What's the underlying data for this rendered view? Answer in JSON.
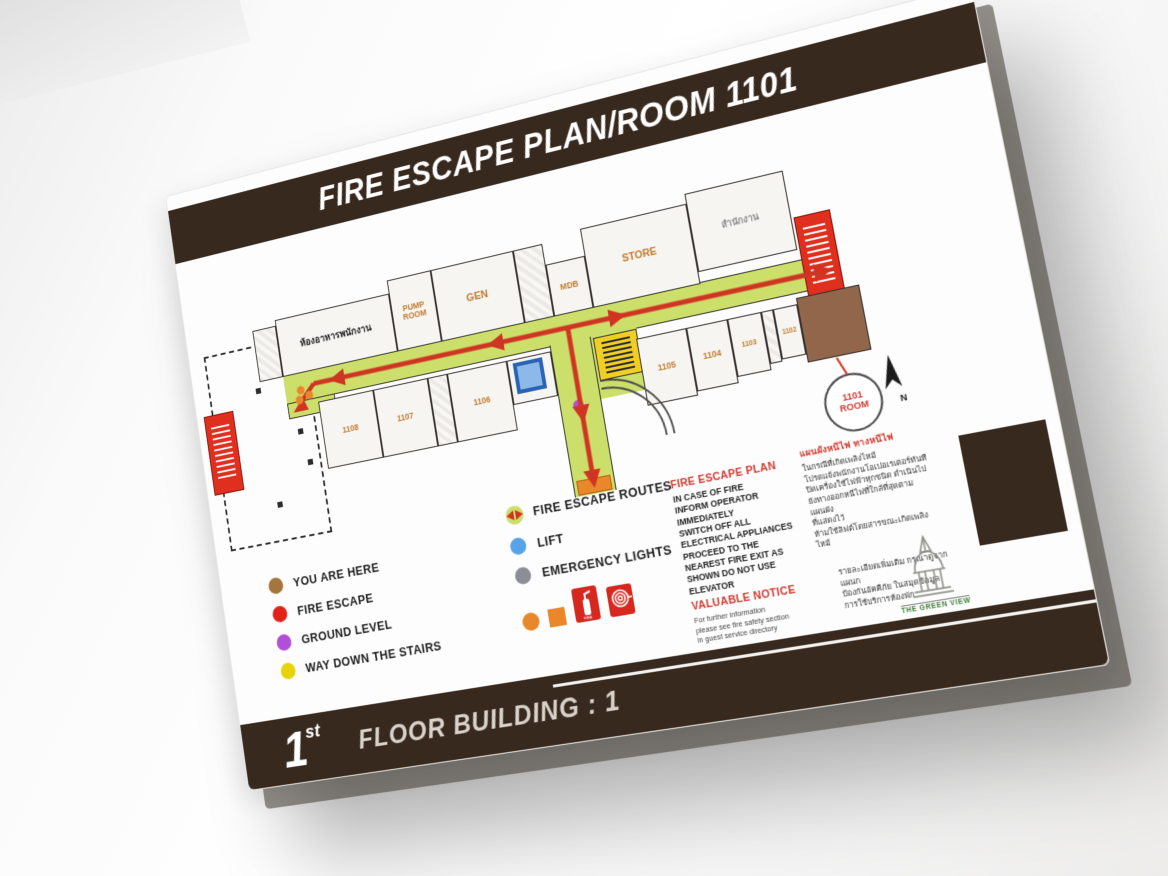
{
  "sign": {
    "title": "FIRE ESCAPE PLAN/ROOM 1101",
    "floor": {
      "number": "1",
      "suffix": "st",
      "text": "FLOOR  BUILDING : 1"
    }
  },
  "plan": {
    "rooms": {
      "staff_canteen": "ห้องอาหารพนักงาน",
      "pump_room": "PUMP ROOM",
      "gen": "GEN",
      "mdb": "MDB",
      "store": "STORE",
      "office": "สำนักงาน",
      "r1102": "1102",
      "r1103": "1103",
      "r1104": "1104",
      "r1105": "1105",
      "r1106": "1106",
      "r1107": "1107",
      "r1108": "1108",
      "r1101_callout": "1101 ROOM"
    },
    "north_label": "N"
  },
  "legend": {
    "left": [
      {
        "color": "#a5763c",
        "label": "YOU ARE HERE"
      },
      {
        "color": "#e32119",
        "label": "FIRE ESCAPE"
      },
      {
        "color": "#b24fd8",
        "label": "GROUND LEVEL"
      },
      {
        "color": "#e8d20a",
        "label": "WAY DOWN THE STAIRS"
      }
    ],
    "right": [
      {
        "icon": "fire-escape-route-icon",
        "label": "FIRE ESCAPE ROUTES"
      },
      {
        "color": "#56a3e8",
        "label": "LIFT"
      },
      {
        "color": "#8d8d95",
        "label": "EMERGENCY LIGHTS"
      }
    ]
  },
  "notices": {
    "fire_escape_plan": {
      "heading": "FIRE ESCAPE PLAN",
      "lines": [
        "IN CASE OF FIRE",
        "INFORM OPERATOR",
        "IMMEDIATELY",
        "SWITCH OFF ALL",
        "ELECTRICAL APPLIANCES",
        "PROCEED TO THE",
        "NEAREST FIRE EXIT AS",
        "SHOWN DO NOT USE",
        "ELEVATOR"
      ]
    },
    "valuable_notice": {
      "heading": "VALUABLE NOTICE",
      "lines": [
        "For further information",
        "please see fire safety section",
        "in guest service directory"
      ]
    },
    "thai_plan": {
      "heading": "แผนผังหนีไฟ ทางหนีไฟ",
      "lines": [
        "ในกรณีที่เกิดเพลิงไหม้",
        "โปรดแจ้งพนักงานโอเปอเรเตอร์ทันที",
        "ปิดเครื่องใช้ไฟฟ้าทุกชนิด ดำเนินไป",
        "ยังทางออกหนีไฟที่ใกล้ที่สุดตามแผนผัง",
        "ที่แสดงไว้",
        "ห้ามใช้ลิฟต์โดยสารขณะเกิดเพลิงไหม้"
      ]
    },
    "thai_info": {
      "lines": [
        "รายละเอียดเพิ่มเติม กรุณาดูจากแผนก",
        "ป้องกันอัคคีภัย ในสมุดข้อมูล",
        "การใช้บริการห้องพัก"
      ]
    },
    "brand": "THE GREEN VIEW"
  },
  "colors": {
    "band_brown": "#38291e",
    "title_text": "#ffffff",
    "route_red": "#cf3522",
    "corridor_green": "#cddf6b",
    "heading_red": "#cf3a30",
    "room_label_orange": "#bf7b2e",
    "you_are_here_room": "#92664b",
    "fire_escape_red": "#df2f1e",
    "stairs_yellow": "#f0cf25",
    "lift_blue": "#8db9e8",
    "ground_purple": "#b24fd8",
    "emergency_gray": "#8d8d95",
    "equipment_orange": "#e8882a",
    "brand_green": "#3f7d3a"
  }
}
